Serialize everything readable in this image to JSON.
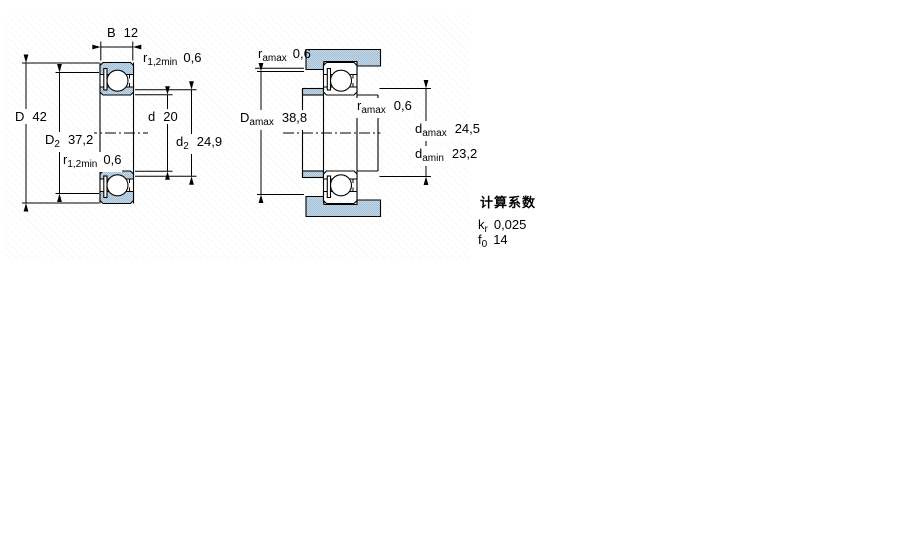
{
  "left_view": {
    "b": {
      "sym": "B",
      "value": "12"
    },
    "r_top": {
      "sym": "r",
      "sub": "1,2min",
      "value": "0,6"
    },
    "D": {
      "sym": "D",
      "value": "42"
    },
    "D2": {
      "sym": "D",
      "sub": "2",
      "value": "37,2"
    },
    "r_mid": {
      "sym": "r",
      "sub": "1,2min",
      "value": "0,6"
    },
    "d": {
      "sym": "d",
      "value": "20"
    },
    "d2": {
      "sym": "d",
      "sub": "2",
      "value": "24,9"
    }
  },
  "right_view": {
    "ra_top": {
      "sym": "r",
      "sub": "amax",
      "value": "0,6"
    },
    "Da": {
      "sym": "D",
      "sub": "amax",
      "value": "38,8"
    },
    "ra_mid": {
      "sym": "r",
      "sub": "amax",
      "value": "0,6"
    },
    "da_max": {
      "sym": "d",
      "sub": "amax",
      "value": "24,5"
    },
    "da_min": {
      "sym": "d",
      "sub": "amin",
      "value": "23,2"
    }
  },
  "calc_factors": {
    "title": "计算系数",
    "rows": [
      {
        "sym": "k",
        "sub": "r",
        "value": "0,025"
      },
      {
        "sym": "f",
        "sub": "0",
        "value": "14"
      }
    ]
  },
  "colors": {
    "steel": "#9dbfd8",
    "steel_light": "#c9d8e4",
    "line": "#000000"
  }
}
